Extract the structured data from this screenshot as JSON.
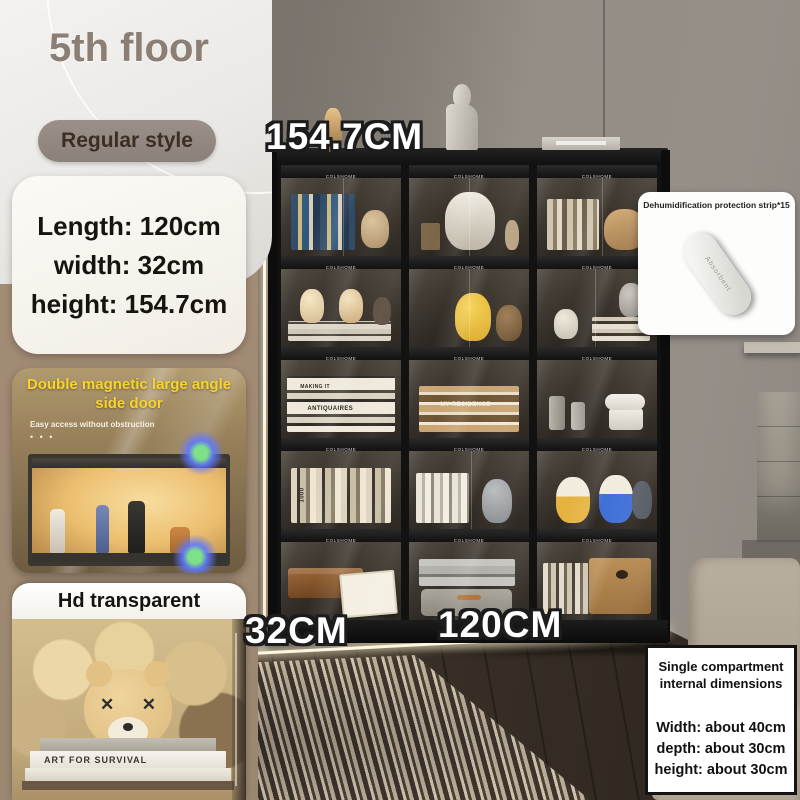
{
  "colors": {
    "accent_yellow": "#f6d42e",
    "badge_bg": "#8c817a",
    "badge_text": "#3b2e23",
    "sidebar_taupe": "#a18a73",
    "card_bg": "#faf8f4",
    "text_dark": "#17140f",
    "label_text": "#ffffff",
    "label_outline": "#1c1c1c",
    "cabinet_frame": "#121212"
  },
  "sidebar": {
    "floor_label": "5th floor",
    "style_badge": "Regular style",
    "dimensions": {
      "length": "Length: 120cm",
      "width": "width: 32cm",
      "height": "height: 154.7cm"
    },
    "feature_card": {
      "title": "Double magnetic large angle side door",
      "subtitle": "Easy access without obstruction",
      "dots": "• • •"
    },
    "hd_card": {
      "title": "Hd transparent",
      "book_spine": "ART FOR SURVIVAL"
    }
  },
  "annotations": {
    "height": "154.7CM",
    "depth": "32CM",
    "width": "120CM"
  },
  "dehumidifier_card": {
    "title": "Dehumidification protection strip*15",
    "strip_label": "Absorbent"
  },
  "internal_dimensions_card": {
    "title_line1": "Single compartment",
    "title_line2": "internal dimensions",
    "width": "Width: about 40cm",
    "depth": "depth: about 30cm",
    "height": "height: about 30cm"
  },
  "cabinet": {
    "brand": "COLSHOME",
    "rows": 5,
    "columns": 3,
    "book_titles": {
      "making_it": "MAKING IT",
      "antiquaires": "ANTIQUAIRES",
      "my_residence": "MY RESIDENCE",
      "thousand": "1000"
    },
    "cells": [
      {
        "contents": "blue and multicolor book spines with tan cat sculpture"
      },
      {
        "contents": "white carved sculpture bookends with small figure"
      },
      {
        "contents": "light books and wooden decor pieces"
      },
      {
        "contents": "two cream cat figurines seated on stacked books"
      },
      {
        "contents": "Pikachu plush figures leaning on books"
      },
      {
        "contents": "KAWS figure, white vase and stacked books"
      },
      {
        "contents": "stacked art books: MAKING IT, ANTIQUAIRES"
      },
      {
        "contents": "stacked MY RESIDENCE books"
      },
      {
        "contents": "white stand mixer with canisters"
      },
      {
        "contents": "vertical row of cream and dark books"
      },
      {
        "contents": "gray KAWS companion figure with white books"
      },
      {
        "contents": "yellow and blue helmet figurines"
      },
      {
        "contents": "wooden chests with framed certificate"
      },
      {
        "contents": "stacked gray boxes and a suitcase"
      },
      {
        "contents": "large wooden box with book row"
      }
    ]
  }
}
